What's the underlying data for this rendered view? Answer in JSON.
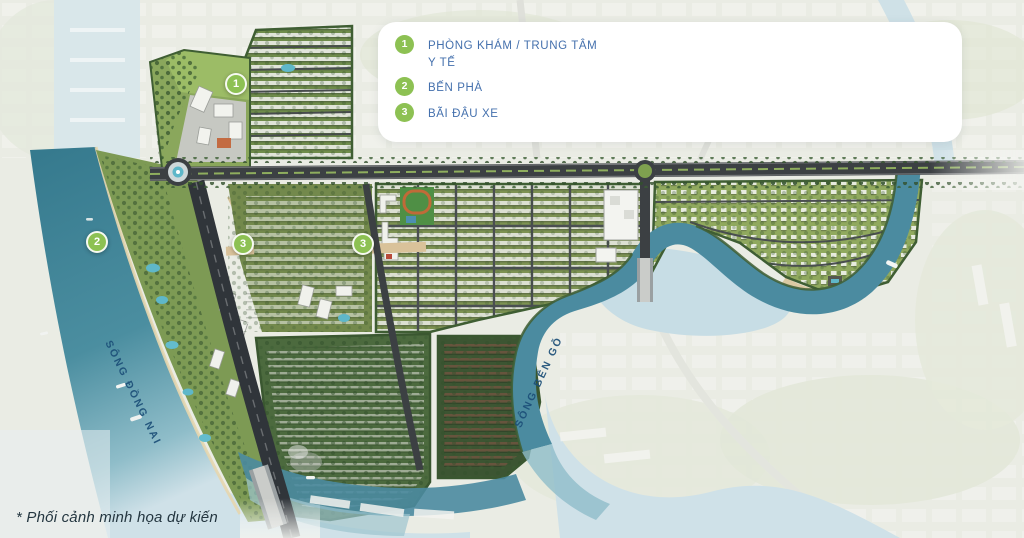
{
  "legend": {
    "items": [
      {
        "number": "1",
        "label": "PHÒNG KHÁM / TRUNG TÂM Y TẾ"
      },
      {
        "number": "2",
        "label": "BẾN PHÀ"
      },
      {
        "number": "3",
        "label": "BÃI ĐẬU XE"
      }
    ]
  },
  "map": {
    "markers": [
      {
        "number": "1",
        "x": 236,
        "y": 84
      },
      {
        "number": "2",
        "x": 97,
        "y": 242
      },
      {
        "number": "3",
        "x": 243,
        "y": 244
      },
      {
        "number": "3",
        "x": 363,
        "y": 244
      }
    ],
    "river_labels": [
      {
        "text": "SÔNG ĐỒNG NAI",
        "x": 133,
        "y": 393,
        "angle": 64
      },
      {
        "text": "SÔNG BẾN GỖ",
        "x": 539,
        "y": 382,
        "angle": -65
      }
    ]
  },
  "caption": {
    "text": "* Phối cảnh minh họa dự kiến"
  },
  "colors": {
    "marker_green": "#8dc153",
    "legend_text": "#4470ad",
    "river_label_blue": "#1c4f78",
    "caption_text": "#243640",
    "water_teal": "#3a7c90",
    "water_pale": "#cfe1e8"
  }
}
